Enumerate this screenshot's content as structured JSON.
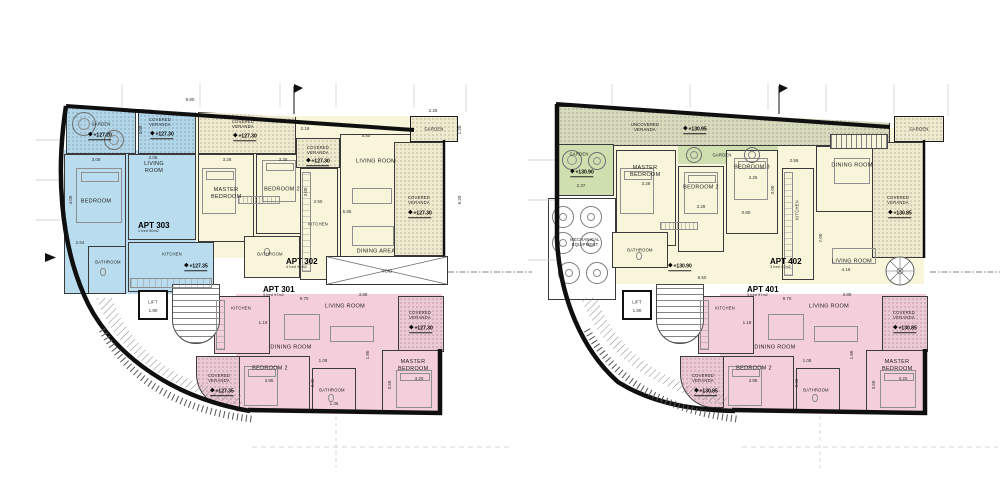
{
  "icons": {
    "level_diamond": "◆"
  },
  "labels": {
    "garden": "GARDEN",
    "covered_veranda": "COVERED VERANDA",
    "uncovered_veranda": "UNCOVERED VERANDA",
    "living_room": "LIVING ROOM",
    "dining_room": "DINING ROOM",
    "dining_area": "DINING AREA",
    "bedroom": "BEDROOM",
    "master_bedroom": "MASTER BEDROOM",
    "bedroom2": "BEDROOM 2",
    "bedroom3": "BEDROOM 3",
    "kitchen": "KITCHEN",
    "bathroom": "BATHROOM",
    "lift": "LIFT",
    "void": "VOID",
    "mechanical": "MECHANICAL EQUIPMENT"
  },
  "dims": {
    "d9_80": "9.80",
    "d5_80": "5.80",
    "d2_25": "2.25",
    "d2_18": "2.18",
    "d2_05": "2.05",
    "d2_09": "2.09",
    "d3_08": "3.08",
    "d4_00": "4.00",
    "d3_28": "3.28",
    "d3_25": "3.25",
    "d3_00": "3.00",
    "d2_50": "2.50",
    "d5_85": "5.85",
    "d6_20": "6.20",
    "d1_20": "1.20",
    "d9_70": "9.70",
    "d3_88": "3.88",
    "d1_18": "1.18",
    "d1_08": "1.08",
    "d1_80": "1.80",
    "d3_85": "3.85",
    "d3_45": "3.45",
    "d3_20": "3.20",
    "d3_50": "3.50",
    "d1_36": "1.36",
    "d2_64": "2.64",
    "d2_37": "2.37",
    "d0_80": "0.80",
    "d2_58": "2.58",
    "d7_00": "7.00",
    "d4_18": "4.18",
    "d8_50": "8.50"
  },
  "plan_left": {
    "apts": {
      "blue": {
        "name": "APT 303",
        "beds": "1 bed",
        "area": "50m2"
      },
      "yellow": {
        "name": "APT 302",
        "beds": "3 bed",
        "area": "92m2"
      },
      "pink": {
        "name": "APT 301",
        "beds": "3 bed",
        "area": "97m2"
      }
    },
    "levels": {
      "garden": "+127.20",
      "cv_top": "+127.30",
      "cv_mid": "+127.30",
      "cv_small": "+127.30",
      "cv_right": "+127.30",
      "core": "+127.35",
      "cv_pink": "+127.30",
      "cv_pink_bl": "+127.35"
    }
  },
  "plan_right": {
    "apts": {
      "yellow": {
        "name": "APT 402",
        "beds": "3 bed",
        "area": "92m2"
      },
      "pink": {
        "name": "APT 401",
        "beds": "3 bed",
        "area": "97m2"
      }
    },
    "levels": {
      "uncovered": "+130.95",
      "garden": "+130.90",
      "core": "+130.90",
      "cv_right": "+130.85",
      "cv_pink": "+130.85",
      "cv_pink_bl": "+130.85"
    }
  }
}
